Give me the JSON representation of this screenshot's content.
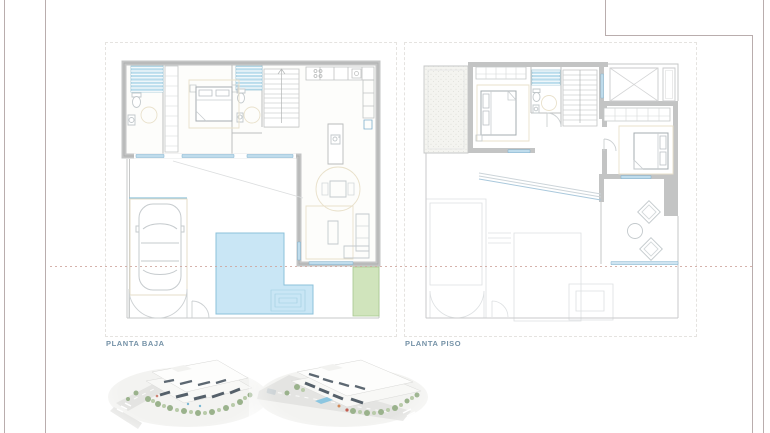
{
  "plans": [
    {
      "label": "PLANTA BAJA"
    },
    {
      "label": "PLANTA PISO"
    }
  ],
  "renders": [
    {
      "name": "aerial-view-render-1"
    },
    {
      "name": "aerial-view-render-2"
    }
  ],
  "colors": {
    "wall": "#c3c4c4",
    "shower": "#b9dcec",
    "window": "#bfdcec",
    "window_edge": "#7fb0cd",
    "pool": "#c9e6f5",
    "pool_edge": "#8cc1da",
    "garden": "#d0e4bc",
    "garden_edge": "#a6c78e",
    "rug_beige": "#e9e1cb",
    "label_text": "#7592a7",
    "section_line": "#cfa49c",
    "frame_line": "#b9adad"
  }
}
